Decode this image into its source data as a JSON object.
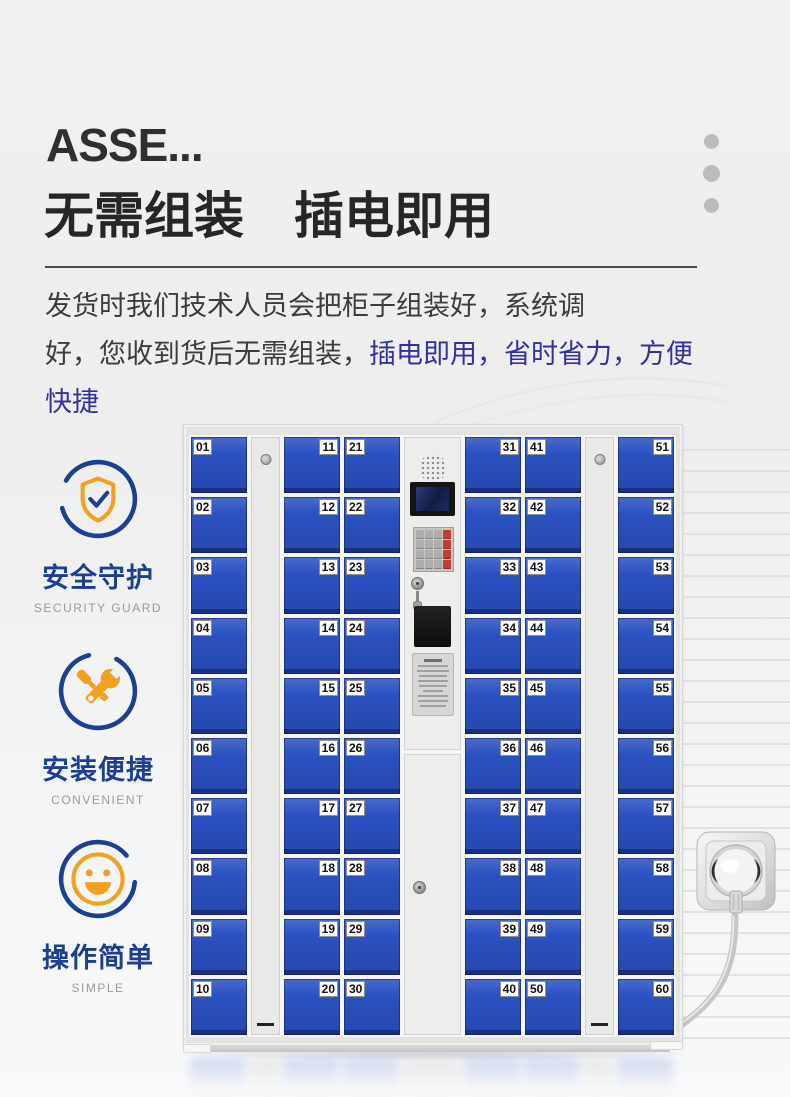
{
  "header": {
    "title_en": "ASSE...",
    "title_zh": "无需组装　插电即用",
    "desc_line1": "发货时我们技术人员会把柜子组装好，系统调",
    "desc_line2_dark": "好，您收到货后无需组装，",
    "desc_line2_blue": "插电即用，省时省力，方便快捷"
  },
  "features": [
    {
      "icon": "shield-check-icon",
      "label": "安全守护",
      "sublabel": "SECURITY GUARD"
    },
    {
      "icon": "tools-icon",
      "label": "安装便捷",
      "sublabel": "CONVENIENT"
    },
    {
      "icon": "smiley-icon",
      "label": "操作简单",
      "sublabel": "SIMPLE"
    }
  ],
  "locker": {
    "columns": [
      {
        "type": "doors",
        "tag_side": "left",
        "numbers": [
          "01",
          "02",
          "03",
          "04",
          "05",
          "06",
          "07",
          "08",
          "09",
          "10"
        ]
      },
      {
        "type": "side-panel"
      },
      {
        "type": "doors",
        "tag_side": "right",
        "numbers": [
          "11",
          "12",
          "13",
          "14",
          "15",
          "16",
          "17",
          "18",
          "19",
          "20"
        ]
      },
      {
        "type": "doors",
        "tag_side": "left",
        "numbers": [
          "21",
          "22",
          "23",
          "24",
          "25",
          "26",
          "27",
          "28",
          "29",
          "30"
        ]
      },
      {
        "type": "control"
      },
      {
        "type": "doors",
        "tag_side": "right",
        "numbers": [
          "31",
          "32",
          "33",
          "34",
          "35",
          "36",
          "37",
          "38",
          "39",
          "40"
        ]
      },
      {
        "type": "doors",
        "tag_side": "left",
        "numbers": [
          "41",
          "42",
          "43",
          "44",
          "45",
          "46",
          "47",
          "48",
          "49",
          "50"
        ]
      },
      {
        "type": "side-panel"
      },
      {
        "type": "doors",
        "tag_side": "right",
        "numbers": [
          "51",
          "52",
          "53",
          "54",
          "55",
          "56",
          "57",
          "58",
          "59",
          "60"
        ]
      }
    ]
  },
  "colors": {
    "door_blue": "#2b52c2",
    "icon_blue": "#1d3f8f",
    "icon_orange": "#f2a01f",
    "text_blue": "#32329e",
    "dot_gray": "#bcbcbc",
    "key_red": "#c23b34"
  }
}
